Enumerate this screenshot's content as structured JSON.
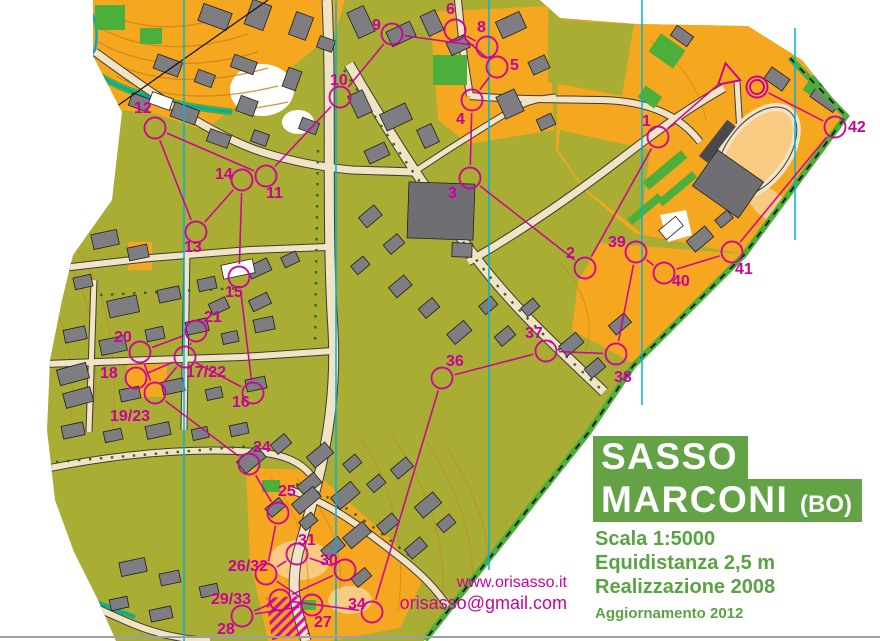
{
  "title": {
    "line1": "SASSO",
    "line2": "MARCONI",
    "line2_suffix": "(BO)",
    "scale": "Scala 1:5000",
    "equidistance": "Equidistanza 2,5 m",
    "realization": "Realizzazione 2008",
    "update": "Aggiornamento 2012"
  },
  "contact": {
    "website": "www.orisasso.it",
    "email": "orisasso@gmail.com"
  },
  "colors": {
    "title_green": "#63a345",
    "magenta": "#cc0099",
    "olive": "#a9ad33",
    "orange": "#f5a71f",
    "pale_orange": "#f9cb82",
    "road_fill": "#f2e3c4",
    "building_grey": "#7d7d82",
    "building_dark": "#6e6e73",
    "vegetation_green": "#4caf3b",
    "north_line": "#00b5d8",
    "contour_brown": "#c8821e",
    "stream_teal": "#00a9b8"
  },
  "map": {
    "north_lines": [
      {
        "x": 184,
        "y1": 0,
        "y2": 641
      },
      {
        "x": 336,
        "y1": 0,
        "y2": 641
      },
      {
        "x": 489,
        "y1": 0,
        "y2": 570
      },
      {
        "x": 642,
        "y1": 0,
        "y2": 405
      },
      {
        "x": 795,
        "y1": 28,
        "y2": 240
      }
    ],
    "start": {
      "x": 728,
      "y": 76
    },
    "finish": {
      "x": 757,
      "y": 87
    },
    "start_toward": "1",
    "controls": [
      {
        "id": "1",
        "label": "1",
        "x": 658,
        "y": 137,
        "lx": 642,
        "ly": 126
      },
      {
        "id": "2",
        "label": "2",
        "x": 585,
        "y": 268,
        "lx": 566,
        "ly": 258
      },
      {
        "id": "3",
        "label": "3",
        "x": 470,
        "y": 178,
        "lx": 448,
        "ly": 198
      },
      {
        "id": "4",
        "label": "4",
        "x": 472,
        "y": 100,
        "lx": 456,
        "ly": 124
      },
      {
        "id": "5",
        "label": "5",
        "x": 497,
        "y": 67,
        "lx": 510,
        "ly": 70
      },
      {
        "id": "6",
        "label": "6",
        "x": 455,
        "y": 30,
        "lx": 446,
        "ly": 14
      },
      {
        "id": "8",
        "label": "8",
        "x": 487,
        "y": 47,
        "lx": 477,
        "ly": 32
      },
      {
        "id": "9",
        "label": "9",
        "x": 392,
        "y": 34,
        "lx": 372,
        "ly": 30
      },
      {
        "id": "10",
        "label": "10",
        "x": 340,
        "y": 97,
        "lx": 330,
        "ly": 85
      },
      {
        "id": "11",
        "label": "11",
        "x": 266,
        "y": 176,
        "lx": 266,
        "ly": 198
      },
      {
        "id": "12",
        "label": "12",
        "x": 155,
        "y": 128,
        "lx": 134,
        "ly": 113
      },
      {
        "id": "13",
        "label": "13",
        "x": 196,
        "y": 232,
        "lx": 184,
        "ly": 252
      },
      {
        "id": "14",
        "label": "14",
        "x": 242,
        "y": 180,
        "lx": 215,
        "ly": 179
      },
      {
        "id": "15",
        "label": "15",
        "x": 239,
        "y": 277,
        "lx": 225,
        "ly": 297
      },
      {
        "id": "16",
        "label": "16",
        "x": 253,
        "y": 393,
        "lx": 232,
        "ly": 407
      },
      {
        "id": "17/22",
        "label": "17/22",
        "x": 185,
        "y": 357,
        "lx": 186,
        "ly": 377
      },
      {
        "id": "18",
        "label": "18",
        "x": 136,
        "y": 378,
        "lx": 100,
        "ly": 378
      },
      {
        "id": "19/23",
        "label": "19/23",
        "x": 155,
        "y": 393,
        "lx": 110,
        "ly": 421
      },
      {
        "id": "20",
        "label": "20",
        "x": 140,
        "y": 352,
        "lx": 114,
        "ly": 342
      },
      {
        "id": "21",
        "label": "21",
        "x": 196,
        "y": 331,
        "lx": 204,
        "ly": 322
      },
      {
        "id": "24",
        "label": "24",
        "x": 249,
        "y": 464,
        "lx": 253,
        "ly": 452
      },
      {
        "id": "25",
        "label": "25",
        "x": 278,
        "y": 513,
        "lx": 278,
        "ly": 496
      },
      {
        "id": "26/32",
        "label": "26/32",
        "x": 266,
        "y": 574,
        "lx": 228,
        "ly": 571
      },
      {
        "id": "27",
        "label": "27",
        "x": 312,
        "y": 605,
        "lx": 314,
        "ly": 627
      },
      {
        "id": "28",
        "label": "28",
        "x": 242,
        "y": 616,
        "lx": 217,
        "ly": 634
      },
      {
        "id": "29/33",
        "label": "29/33",
        "x": 280,
        "y": 600,
        "lx": 211,
        "ly": 604
      },
      {
        "id": "30",
        "label": "30",
        "x": 345,
        "y": 570,
        "lx": 320,
        "ly": 565
      },
      {
        "id": "31",
        "label": "31",
        "x": 297,
        "y": 554,
        "lx": 298,
        "ly": 545
      },
      {
        "id": "34",
        "label": "34",
        "x": 372,
        "y": 612,
        "lx": 348,
        "ly": 609
      },
      {
        "id": "36",
        "label": "36",
        "x": 442,
        "y": 378,
        "lx": 446,
        "ly": 366
      },
      {
        "id": "37",
        "label": "37",
        "x": 546,
        "y": 351,
        "lx": 525,
        "ly": 338
      },
      {
        "id": "38",
        "label": "38",
        "x": 616,
        "y": 354,
        "lx": 614,
        "ly": 382
      },
      {
        "id": "39",
        "label": "39",
        "x": 636,
        "y": 252,
        "lx": 608,
        "ly": 247
      },
      {
        "id": "40",
        "label": "40",
        "x": 664,
        "y": 273,
        "lx": 672,
        "ly": 286
      },
      {
        "id": "41",
        "label": "41",
        "x": 732,
        "y": 252,
        "lx": 735,
        "ly": 274
      },
      {
        "id": "42",
        "label": "42",
        "x": 835,
        "y": 127,
        "lx": 848,
        "ly": 132
      }
    ],
    "segments": [
      [
        "S",
        "1"
      ],
      [
        "1",
        "2"
      ],
      [
        "2",
        "3"
      ],
      [
        "3",
        "4"
      ],
      [
        "4",
        "5"
      ],
      [
        "5",
        "6"
      ],
      [
        "6",
        "8"
      ],
      [
        "8",
        "9"
      ],
      [
        "9",
        "10"
      ],
      [
        "10",
        "11"
      ],
      [
        "11",
        "12"
      ],
      [
        "12",
        "13"
      ],
      [
        "13",
        "14"
      ],
      [
        "14",
        "15"
      ],
      [
        "15",
        "16"
      ],
      [
        "16",
        "17/22"
      ],
      [
        "17/22",
        "18"
      ],
      [
        "18",
        "19/23"
      ],
      [
        "19/23",
        "20"
      ],
      [
        "20",
        "21"
      ],
      [
        "21",
        "17/22"
      ],
      [
        "17/22",
        "19/23"
      ],
      [
        "19/23",
        "24"
      ],
      [
        "24",
        "25"
      ],
      [
        "25",
        "26/32"
      ],
      [
        "26/32",
        "27"
      ],
      [
        "27",
        "28"
      ],
      [
        "28",
        "29/33"
      ],
      [
        "29/33",
        "30"
      ],
      [
        "30",
        "31"
      ],
      [
        "31",
        "26/32"
      ],
      [
        "29/33",
        "34"
      ],
      [
        "34",
        "36"
      ],
      [
        "36",
        "37"
      ],
      [
        "37",
        "38"
      ],
      [
        "38",
        "39"
      ],
      [
        "39",
        "40"
      ],
      [
        "40",
        "41"
      ],
      [
        "41",
        "42"
      ],
      [
        "42",
        "F"
      ]
    ]
  }
}
